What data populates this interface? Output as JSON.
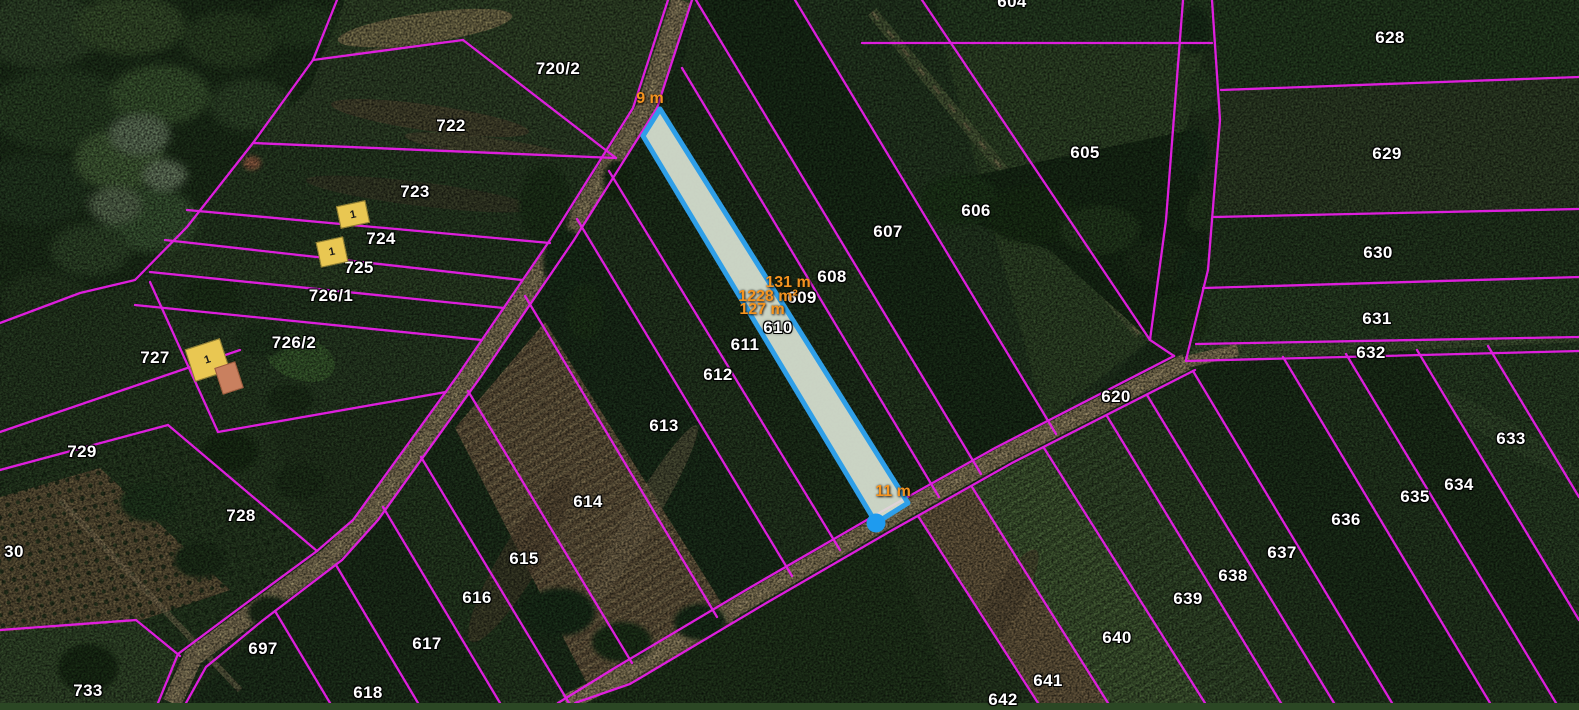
{
  "map": {
    "colors": {
      "boundary": "#e81ee8",
      "selection_stroke": "#2f9fe8",
      "selection_fill": "rgba(222,231,215,0.9)",
      "vertex_dot": "#1e9bef",
      "measure_text": "#f5941f",
      "label_text": "#ffffff",
      "building_fill": "#e9c752",
      "building_roof": "#c9805f"
    },
    "parcel_labels": [
      {
        "text": "720/2",
        "x": 558,
        "y": 69
      },
      {
        "text": "722",
        "x": 451,
        "y": 126
      },
      {
        "text": "723",
        "x": 415,
        "y": 192
      },
      {
        "text": "724",
        "x": 381,
        "y": 239
      },
      {
        "text": "725",
        "x": 359,
        "y": 268
      },
      {
        "text": "726/1",
        "x": 331,
        "y": 296
      },
      {
        "text": "726/2",
        "x": 294,
        "y": 343
      },
      {
        "text": "727",
        "x": 155,
        "y": 358
      },
      {
        "text": "729",
        "x": 82,
        "y": 452
      },
      {
        "text": "728",
        "x": 241,
        "y": 516
      },
      {
        "text": "30",
        "x": 14,
        "y": 552
      },
      {
        "text": "733",
        "x": 88,
        "y": 691
      },
      {
        "text": "697",
        "x": 263,
        "y": 649
      },
      {
        "text": "618",
        "x": 368,
        "y": 693
      },
      {
        "text": "617",
        "x": 427,
        "y": 644
      },
      {
        "text": "616",
        "x": 477,
        "y": 598
      },
      {
        "text": "615",
        "x": 524,
        "y": 559
      },
      {
        "text": "614",
        "x": 588,
        "y": 502
      },
      {
        "text": "613",
        "x": 664,
        "y": 426
      },
      {
        "text": "612",
        "x": 718,
        "y": 375
      },
      {
        "text": "611",
        "x": 745,
        "y": 345
      },
      {
        "text": "610",
        "x": 778,
        "y": 328
      },
      {
        "text": "609",
        "x": 802,
        "y": 298
      },
      {
        "text": "608",
        "x": 832,
        "y": 277
      },
      {
        "text": "607",
        "x": 888,
        "y": 232
      },
      {
        "text": "606",
        "x": 976,
        "y": 211
      },
      {
        "text": "605",
        "x": 1085,
        "y": 153
      },
      {
        "text": "604",
        "x": 1012,
        "y": 2
      },
      {
        "text": "620",
        "x": 1116,
        "y": 397
      },
      {
        "text": "628",
        "x": 1390,
        "y": 38
      },
      {
        "text": "629",
        "x": 1387,
        "y": 154
      },
      {
        "text": "630",
        "x": 1378,
        "y": 253
      },
      {
        "text": "631",
        "x": 1377,
        "y": 319
      },
      {
        "text": "632",
        "x": 1371,
        "y": 353
      },
      {
        "text": "633",
        "x": 1511,
        "y": 439
      },
      {
        "text": "634",
        "x": 1459,
        "y": 485
      },
      {
        "text": "635",
        "x": 1415,
        "y": 497
      },
      {
        "text": "636",
        "x": 1346,
        "y": 520
      },
      {
        "text": "637",
        "x": 1282,
        "y": 553
      },
      {
        "text": "638",
        "x": 1233,
        "y": 576
      },
      {
        "text": "639",
        "x": 1188,
        "y": 599
      },
      {
        "text": "640",
        "x": 1117,
        "y": 638
      },
      {
        "text": "641",
        "x": 1048,
        "y": 681
      },
      {
        "text": "642",
        "x": 1003,
        "y": 700
      }
    ],
    "measure_labels": [
      {
        "text": "9 m",
        "x": 650,
        "y": 99
      },
      {
        "text": "131 m",
        "x": 788,
        "y": 283
      },
      {
        "text": "1228 m²",
        "x": 768,
        "y": 297
      },
      {
        "text": "127 m",
        "x": 762,
        "y": 310
      },
      {
        "text": "11 m",
        "x": 893,
        "y": 492
      }
    ],
    "building_markers": [
      {
        "label": "1",
        "x": 353,
        "y": 214,
        "w": 30,
        "h": 23,
        "angle": -12,
        "type": "yellow"
      },
      {
        "label": "1",
        "x": 332,
        "y": 252,
        "w": 28,
        "h": 26,
        "angle": -12,
        "type": "yellow"
      },
      {
        "label": "1",
        "x": 207,
        "y": 360,
        "w": 37,
        "h": 34,
        "angle": -18,
        "type": "yellow"
      },
      {
        "label": "",
        "x": 229,
        "y": 378,
        "w": 22,
        "h": 28,
        "angle": -18,
        "type": "roof"
      }
    ],
    "selected_parcel": {
      "points": "660,109 908,503 876,523 643,136",
      "vertex": {
        "x": 876,
        "y": 523
      }
    }
  }
}
